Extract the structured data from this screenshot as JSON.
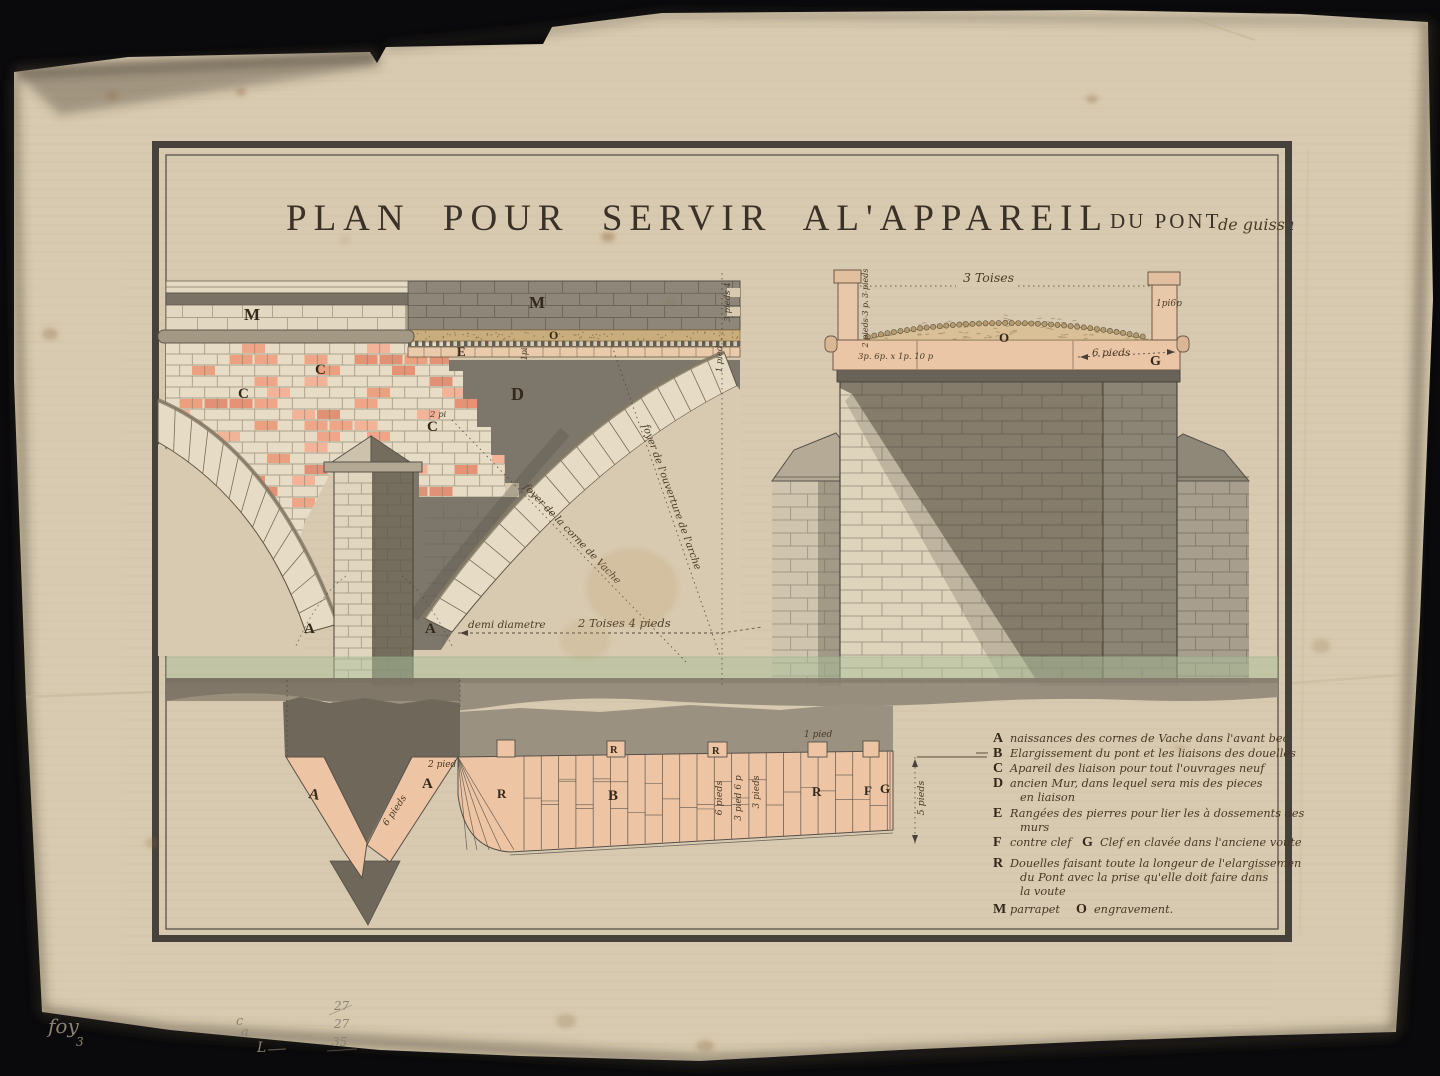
{
  "title": {
    "main": "PLAN POUR SERVIR AL'APPAREIL",
    "sub": "DU PONT",
    "script": "de guissa"
  },
  "colors": {
    "paper": "#d8cab0",
    "ink": "#4a3a26",
    "frame": "#46413a",
    "brick_accent": "#ea9678",
    "pink_masonry": "#eec5a4",
    "tan_gravel": "#c9ad7d",
    "dark_wall": "#7d766a",
    "water_green": "#a9bf9a"
  },
  "left": {
    "labels": {
      "m1": "M",
      "m2": "M",
      "c1": "C",
      "c2": "C",
      "c3": "C",
      "e": "E",
      "o": "O",
      "d": "D",
      "a1": "A",
      "a2": "A"
    },
    "dims": {
      "two_pi": "2 pi",
      "one_pi": "1pi",
      "edge_top": "3 pieds 4",
      "edge_bot": "1 pied",
      "demi": "demi diametre",
      "toises": "2 Toises 4 pieds",
      "foyer1": "foyer de la corne de Vache",
      "foyer2": "foyer de l'ouverture de l'arche"
    }
  },
  "right": {
    "labels": {
      "o": "O",
      "g": "G"
    },
    "dims": {
      "toises": "3 Toises",
      "post_left": "2 pieds 3 p. 3 pieds",
      "post_right": "1pi6p",
      "deck": "3p. 6p. x 1p. 10 p",
      "six_pieds": "6 pieds"
    }
  },
  "plan": {
    "labels": {
      "a1": "A",
      "a2": "A",
      "r1": "R",
      "r_tab1": "R",
      "b": "B",
      "r_tab2": "R",
      "r2": "R",
      "f": "F",
      "g": "G"
    },
    "dims": {
      "two_pied": "2 pied",
      "six_pieds_chevron": "6 pieds",
      "six_pieds_band": "6 pieds",
      "three_p_six": "3 pied 6 p",
      "three_pieds": "3 pieds",
      "one_pied": "1 pied",
      "five_pieds": "5 pieds"
    }
  },
  "legend": {
    "rows": [
      {
        "label": "A",
        "text": "naissances des cornes de Vache dans l'avant bec"
      },
      {
        "label": "B",
        "text": "Elargissement du pont et les liaisons des douelles"
      },
      {
        "label": "C",
        "text": "Apareil des liaison pour tout l'ouvrages neuf"
      },
      {
        "label": "D",
        "text": "ancien Mur, dans lequel sera mis des pieces"
      },
      {
        "label": "",
        "text": "en liaison",
        "indent": true
      },
      {
        "label": "E",
        "text": "Rangées des pierres pour lier les à dossements des"
      },
      {
        "label": "",
        "text": "murs",
        "indent": true
      },
      {
        "label": "F",
        "text": "contre clef",
        "label2": "G",
        "text2": "Clef en clavée dans l'anciene voute"
      },
      {
        "label": "R",
        "text": "Douelles faisant toute la longeur de l'elargissemen"
      },
      {
        "label": "",
        "text": "du Pont avec la prise qu'elle doit faire dans",
        "indent": true
      },
      {
        "label": "",
        "text": "la voute",
        "indent": true
      },
      {
        "label": "M",
        "text": "parrapet",
        "label2": "O",
        "text2": "engravement."
      }
    ]
  },
  "pencil": {
    "foy": "foy",
    "three": "3",
    "c": "c",
    "a": "a",
    "l": "L",
    "n1": "27",
    "n2": "27",
    "n3": "35"
  }
}
